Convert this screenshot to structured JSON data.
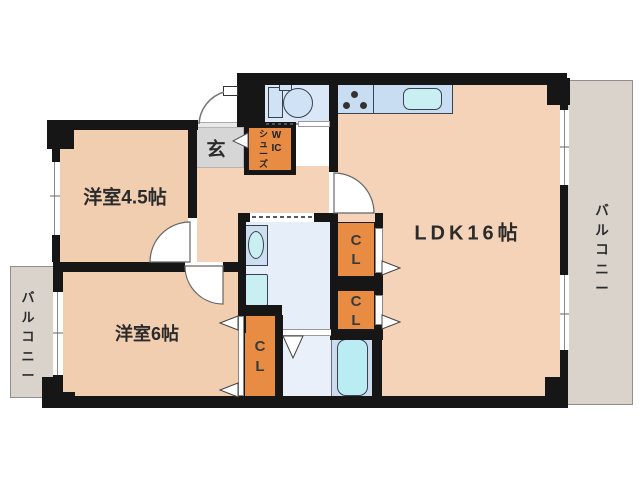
{
  "floorplan": {
    "rooms": {
      "western_room_45": "洋室4.5帖",
      "western_room_6": "洋室6帖",
      "ldk": "LDK16帖",
      "entrance": "玄",
      "shoe_closet_shoes": "シューズ",
      "shoe_closet_wic": "WIC"
    },
    "closets": [
      "CL",
      "CL",
      "CL"
    ],
    "balconies": [
      "バルコニー",
      "バルコニー"
    ],
    "colors": {
      "wall": "#161616",
      "floor": "#f2ceb1",
      "floor_ldk": "#f5d3b8",
      "closet_orange": "#e78c42",
      "entrance_gray": "#d6d6d6",
      "balcony_gray": "#d9d3cc",
      "toilet_blue": "#d9e7f6",
      "washroom_blue": "#e6eefa",
      "counter_blue": "#c9ddf2",
      "fixture_cyan": "#c9eff2",
      "tub_section_blue": "#ccdcec",
      "text_dark": "#2b2b2b"
    }
  }
}
